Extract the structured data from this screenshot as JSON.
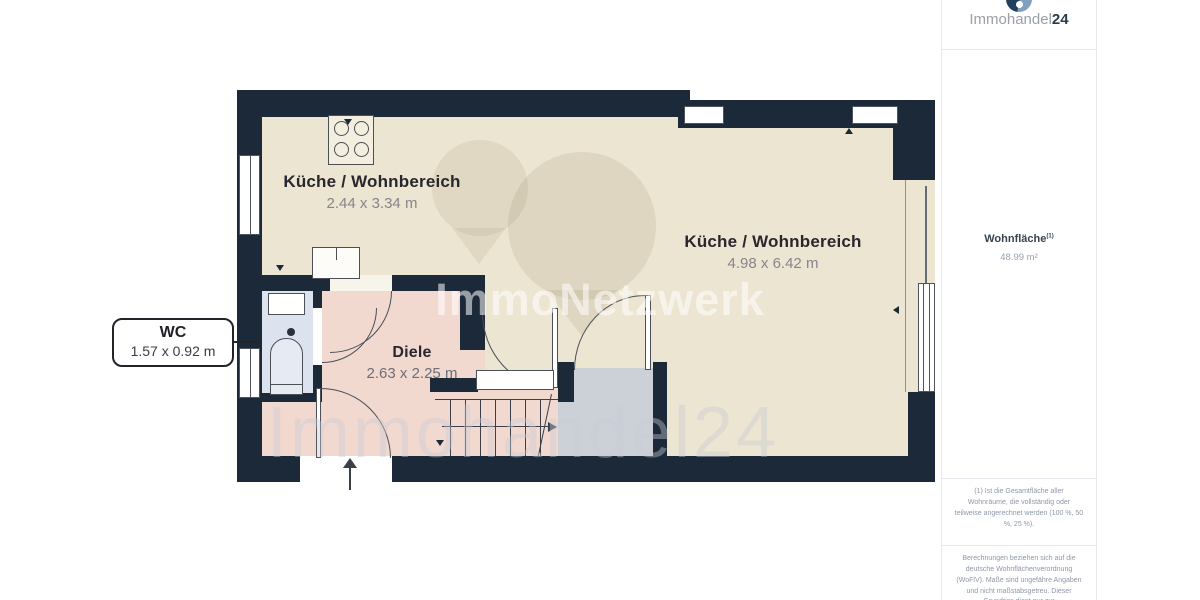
{
  "branding": {
    "logo_text": "Immohandel",
    "logo_suffix": "24",
    "watermark_center": "ImmoNetzwerk",
    "watermark_bottom": "Immohandel24"
  },
  "sidebar": {
    "area_label": "Wohnfläche",
    "area_sup": "(1)",
    "area_value": "48.99 m²",
    "footnote1": "(1) Ist die Gesamtfläche aller Wohnräume, die vollständig oder teilweise angerechnet werden (100 %, 50 %, 25 %).",
    "footnote2": "Berechnungen beziehen sich auf die deutsche Wohnflächenverordnung (WoFlV). Maße sind ungefähre Angaben und nicht maßstabsgetreu. Dieser Grundriss dient nur zur"
  },
  "rooms": [
    {
      "name": "Küche / Wohnbereich",
      "dims": "2.44 x 3.34 m"
    },
    {
      "name": "Küche / Wohnbereich",
      "dims": "4.98 x 6.42 m"
    },
    {
      "name": "Diele",
      "dims": "2.63 x 2.25 m"
    },
    {
      "name": "WC",
      "dims": "1.57 x 0.92 m"
    }
  ],
  "colors": {
    "wall": "#1c2939",
    "room_main": "#ece5d1",
    "room_hall": "#f2d9d0",
    "room_wc": "#dce2ee",
    "room_storage": "#ccd0d7",
    "logo_accent": "#20405c"
  }
}
